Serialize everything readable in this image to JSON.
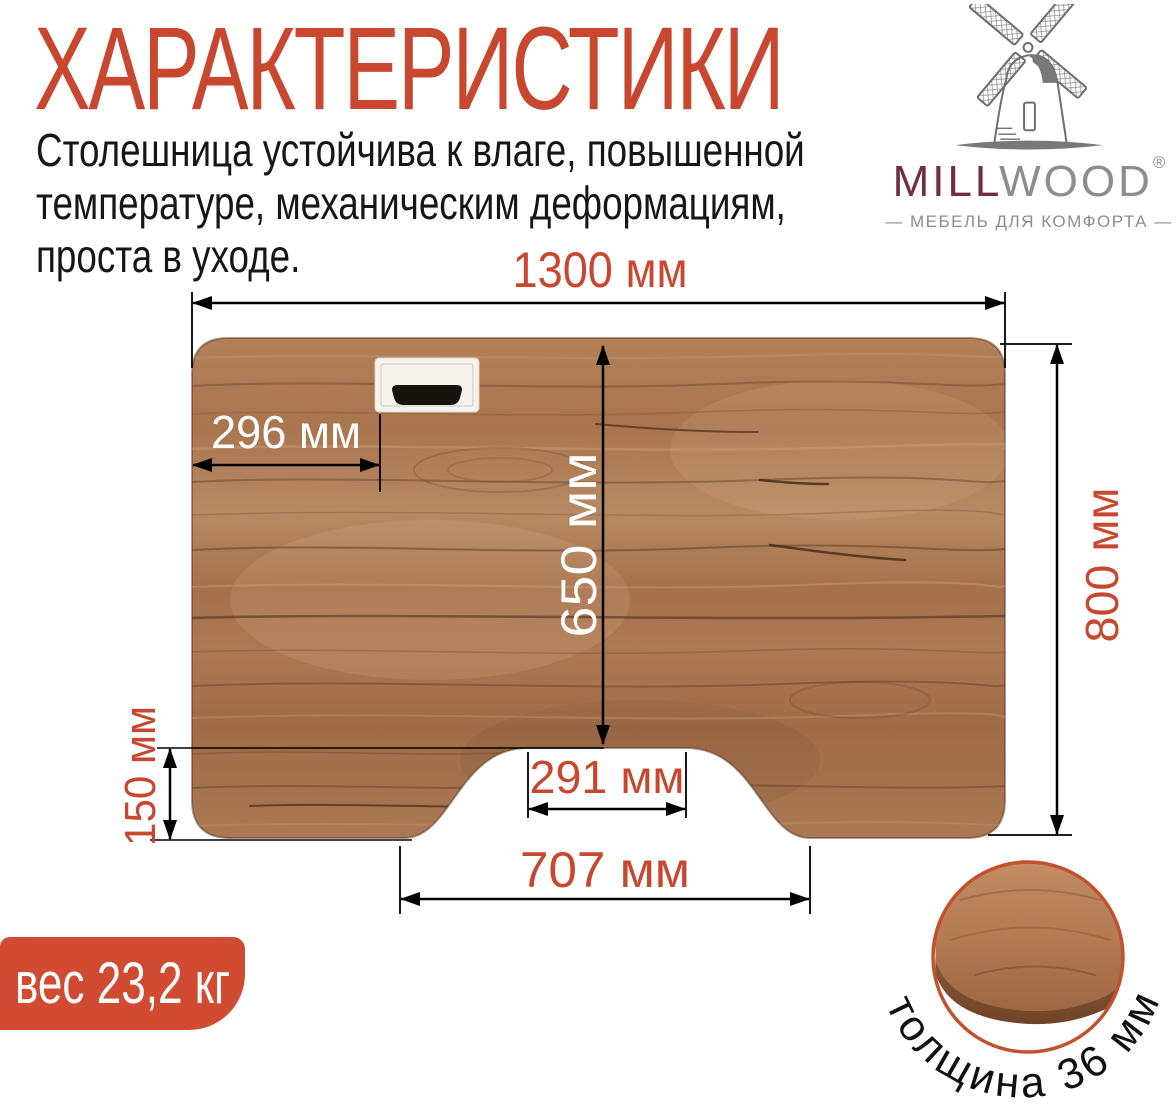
{
  "title": "ХАРАКТЕРИСТИКИ",
  "description": "Столешница устойчива к влаге, повышенной\nтемпературе, механическим деформациям,\nпроста в уходе.",
  "logo": {
    "brand_first": "MILL",
    "brand_second": "WOOD",
    "registered": "®",
    "tagline": "— МЕБЕЛЬ ДЛЯ КОМФОРТА —",
    "icon": "windmill-icon"
  },
  "dimensions": {
    "top_width": "1300 мм",
    "grommet_offset": "296 мм",
    "center_depth": "650 мм",
    "total_depth": "800 мм",
    "side_depth": "150 мм",
    "cutout_top_width": "291 мм",
    "cutout_bottom_width": "707 мм"
  },
  "weight_badge": "вес 23,2 кг",
  "thickness_label": "толщина 36 мм",
  "colors": {
    "accent_red": "#C8472F",
    "badge_red": "#D04B31",
    "ring_red": "#C2512E",
    "text_dark": "#161616",
    "logo_gray": "#8D8D8D",
    "logo_maroon": "#722E40",
    "wood_mid": "#A9754F",
    "wood_dark": "#6E4730",
    "wood_light": "#C1916A",
    "dimension_line": "#000000",
    "dimension_text_on_wood": "#FFFFFF"
  }
}
